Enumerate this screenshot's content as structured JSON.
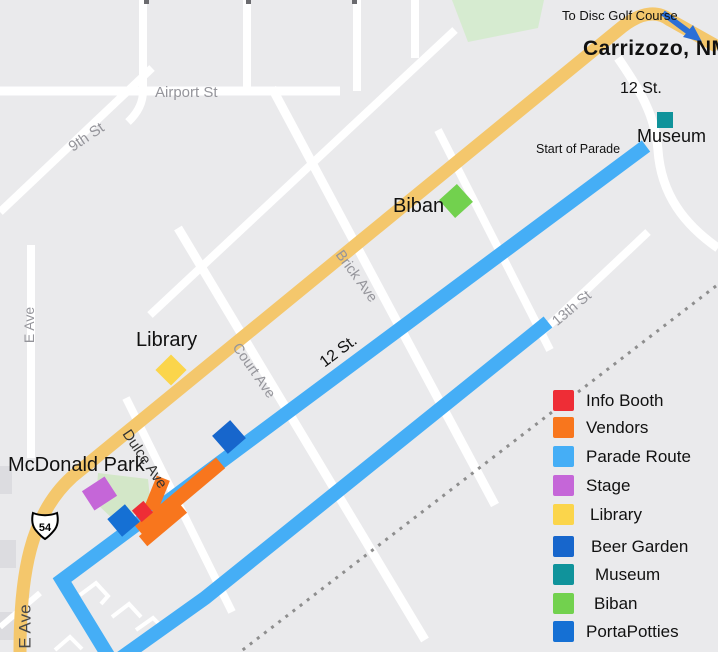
{
  "map": {
    "labels": {
      "to_disc_golf": "To Disc Golf Course",
      "city": "Carrizozo, NM",
      "twelfth_st_top": "12 St.",
      "museum": "Museum",
      "start_of_parade": "Start of Parade",
      "biban": "Biban",
      "brick_ave": "Brick Ave",
      "thirteenth_st": "13th St",
      "twelfth_st_route": "12 St.",
      "library": "Library",
      "court_ave": "Court Ave",
      "e_ave_top": "E Ave",
      "ninth_st": "9th St",
      "airport_st": "Airport St",
      "dulce_ave": "Dulce Ave",
      "mcdonald_park": "McDonald Park",
      "e_ave_bottom": "E Ave",
      "highway_shield": "54"
    },
    "colors": {
      "background": "#eaeaec",
      "road": "#ffffff",
      "highway": "#f4c76c",
      "park": "#d3e7c8",
      "railroad": "#8e8e8e",
      "route": "#45aef6",
      "arrow": "#2b6fd6",
      "street_label": "#95959b",
      "building": "#dcdce0"
    }
  },
  "legend": {
    "items": [
      {
        "label": "Info Booth",
        "color": "#ee2d36"
      },
      {
        "label": "Vendors",
        "color": "#f8761d"
      },
      {
        "label": "Parade Route",
        "color": "#45aef6"
      },
      {
        "label": "Stage",
        "color": "#c566d8"
      },
      {
        "label": "Library",
        "color": "#fbd54b"
      },
      {
        "label": "Beer Garden",
        "color": "#1766cc"
      },
      {
        "label": "Museum",
        "color": "#10939b"
      },
      {
        "label": "Biban",
        "color": "#72d14e"
      },
      {
        "label": "PortaPotties",
        "color": "#1570d4"
      }
    ]
  }
}
